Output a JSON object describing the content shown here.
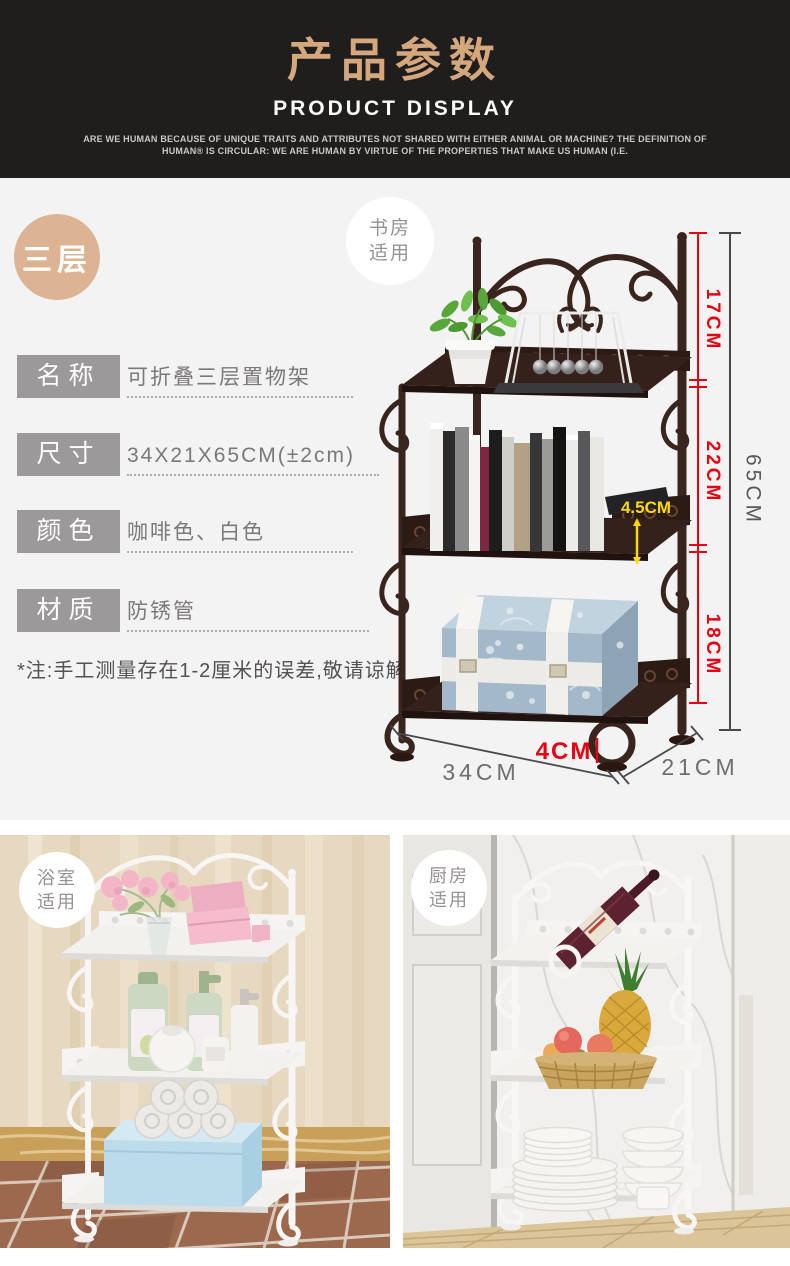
{
  "header": {
    "title": "产品参数",
    "subtitle": "PRODUCT DISPLAY",
    "tagline1": "ARE WE HUMAN BECAUSE OF UNIQUE TRAITS AND ATTRIBUTES NOT SHARED WITH EITHER ANIMAL OR MACHINE? THE DEFINITION OF",
    "tagline2": "HUMAN®  IS CIRCULAR: WE ARE HUMAN BY VIRTUE OF THE PROPERTIES THAT MAKE US HUMAN (I.E."
  },
  "tier_badge": "三层",
  "scene_badges": {
    "study": {
      "line1": "书房",
      "line2": "适用"
    },
    "bathroom": {
      "line1": "浴室",
      "line2": "适用"
    },
    "kitchen": {
      "line1": "厨房",
      "line2": "适用"
    }
  },
  "specs": {
    "rows": [
      {
        "label": "名称",
        "value": "可折叠三层置物架"
      },
      {
        "label": "尺寸",
        "value": "34X21X65CM(±2cm)"
      },
      {
        "label": "颜色",
        "value": "咖啡色、白色"
      },
      {
        "label": "材质",
        "value": "防锈管"
      }
    ],
    "note": "*注:手工测量存在1-2厘米的误差,敬请谅解"
  },
  "dimensions": {
    "tier1_height": "17CM",
    "tier2_height": "22CM",
    "tier3_height": "18CM",
    "total_height": "65CM",
    "rail_height": "4.5CM",
    "foot_height": "4CM",
    "width": "34CM",
    "depth": "21CM"
  },
  "colors": {
    "accent_gold": "#d5a77d",
    "dimension_red": "#e60012",
    "dimension_yellow": "#ffd900",
    "dimension_gray": "#595757",
    "iron_brown": "#3a241e",
    "label_gray": "#9b999a"
  }
}
